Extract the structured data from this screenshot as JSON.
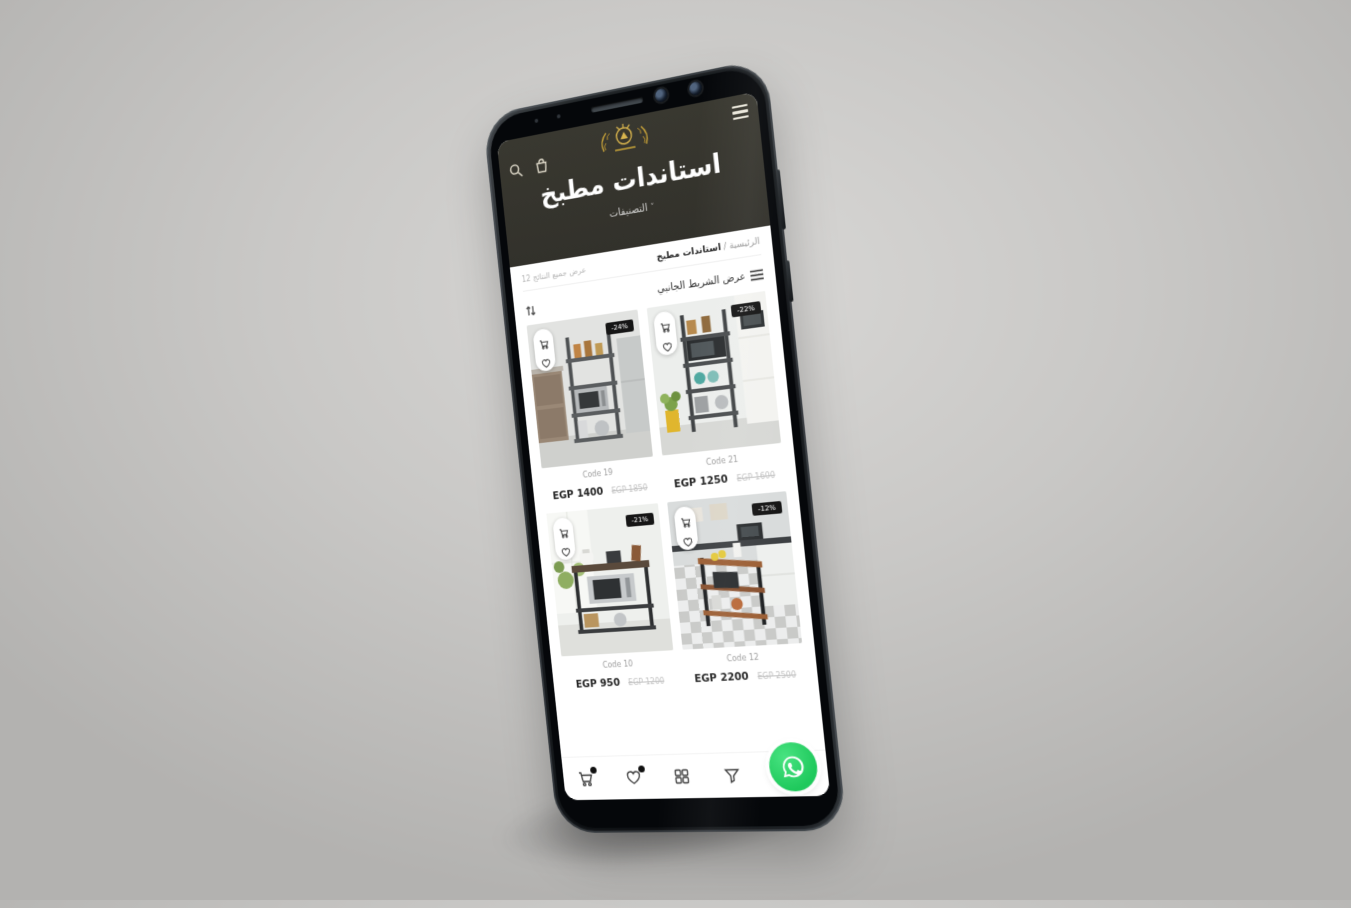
{
  "device": {
    "type": "smartphone-mockup",
    "hardware": [
      "speaker-grille",
      "front-camera-1",
      "front-camera-2",
      "proximity-sensor",
      "volume-button",
      "power-button"
    ]
  },
  "header": {
    "title": "استاندات مطبخ",
    "categories_label": "التصنيفات",
    "categories_chevron": "˅",
    "icons": {
      "menu": "hamburger-lines",
      "search": "magnifier",
      "cart": "shopping-bag",
      "logo": "gold-crest-emblem"
    },
    "bg_color": "#32312b"
  },
  "breadcrumb": {
    "home": "الرئيسية",
    "separator": " / ",
    "current": "استاندات مطبخ"
  },
  "results_label": "عرض جميع النتائج 12",
  "toolbar": {
    "sidebar_toggle_label": "عرض الشريط الجانبي",
    "sort_icon": "up-down-arrows",
    "list_icon": "list-lines"
  },
  "products": [
    {
      "code": "Code 19",
      "price": "EGP 1400",
      "old_price": "EGP 1850",
      "discount": "-24%"
    },
    {
      "code": "Code 21",
      "price": "EGP 1250",
      "old_price": "EGP 1600",
      "discount": "-22%"
    },
    {
      "code": "Code 10",
      "price": "EGP 950",
      "old_price": "EGP 1200",
      "discount": "-21%"
    },
    {
      "code": "Code 12",
      "price": "EGP 2200",
      "old_price": "EGP 2500",
      "discount": "-12%"
    }
  ],
  "card_actions": {
    "add_to_cart": "cart-icon",
    "wishlist": "heart-icon"
  },
  "bottom_nav": {
    "items": [
      {
        "name": "cart",
        "icon": "cart",
        "badge_dot": true
      },
      {
        "name": "wishlist",
        "icon": "heart",
        "badge_dot": true
      },
      {
        "name": "categories",
        "icon": "grid",
        "badge_dot": false
      },
      {
        "name": "filter",
        "icon": "funnel",
        "badge_dot": false
      }
    ]
  },
  "floating_button": {
    "name": "whatsapp",
    "icon": "whatsapp-bubble",
    "color": "#25d366"
  },
  "colors": {
    "header_bg": "#32312b",
    "logo_gold": "#c9a43a",
    "whatsapp_green": "#25d366",
    "discount_badge_bg": "#161616",
    "price_text": "#242424",
    "muted_text": "#a0a0a0",
    "backdrop_gray": "#c9c8c6"
  }
}
